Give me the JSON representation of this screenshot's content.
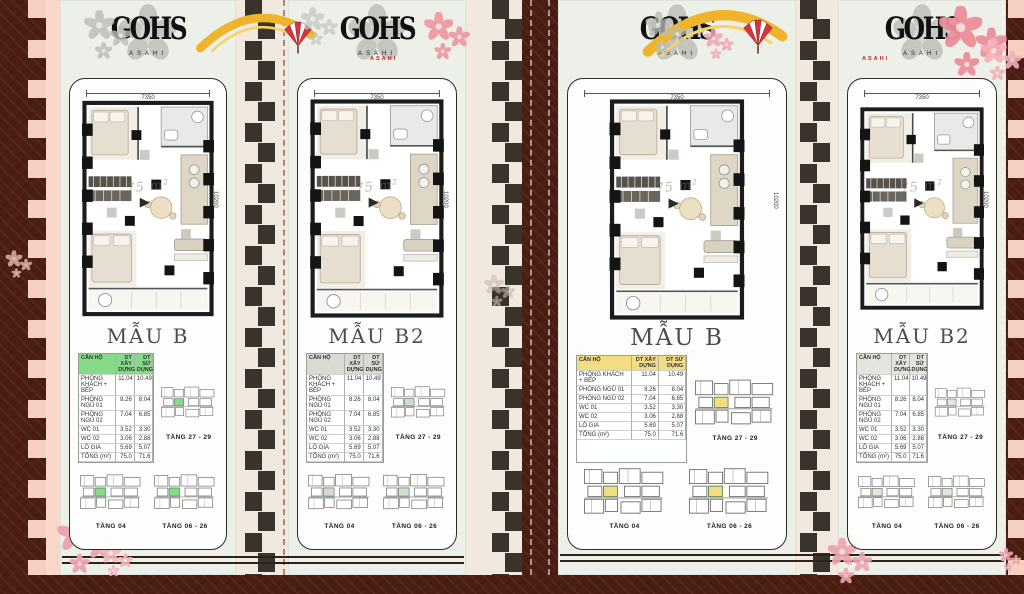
{
  "brand": {
    "logo_text": "GOHS",
    "logo_subtext": "ASAHI",
    "fan_label": "ASAHI"
  },
  "cards": [
    {
      "title": "MẪU B",
      "dim_top": "7350",
      "dim_side": "10200",
      "watermark": "75 m²",
      "upper_floor_label": "TẦNG 27 - 29",
      "bottom_floor_labels": [
        "TẦNG 04",
        "TẦNG 06 - 26"
      ],
      "accent": "#86db8b"
    },
    {
      "title": "MẪU B2",
      "dim_top": "7350",
      "dim_side": "10200",
      "watermark": "75 m²",
      "upper_floor_label": "TẦNG 27 - 29",
      "bottom_floor_labels": [
        "TẦNG 04",
        "TẦNG 06 - 26"
      ],
      "accent": "#d7dbd2"
    },
    {
      "title": "MẪU B",
      "dim_top": "7350",
      "dim_side": "10200",
      "watermark": "75 m²",
      "upper_floor_label": "TẦNG 27 - 29",
      "bottom_floor_labels": [
        "TẦNG 04",
        "TẦNG 06 - 26"
      ],
      "accent": "#f3dc82"
    },
    {
      "title": "MẪU B2",
      "dim_top": "7350",
      "dim_side": "10200",
      "watermark": "75 m²",
      "upper_floor_label": "TẦNG 27 - 29",
      "bottom_floor_labels": [
        "TẦNG 04",
        "TẦNG 06 - 26"
      ],
      "accent": "#e3e6df"
    }
  ],
  "table": {
    "header": [
      "CĂN HỘ",
      "DT XÂY DỰNG",
      "DT SỬ DỤNG"
    ],
    "rows": [
      [
        "PHÒNG KHÁCH + BẾP",
        "11.04",
        "10.49"
      ],
      [
        "PHÒNG NGỦ 01",
        "8.26",
        "8.04"
      ],
      [
        "PHÒNG NGỦ 02",
        "7.04",
        "6.85"
      ],
      [
        "WC 01",
        "3.52",
        "3.30"
      ],
      [
        "WC 02",
        "3.06",
        "2.88"
      ],
      [
        "LÔ GIA",
        "5.69",
        "5.07"
      ],
      [
        "TỔNG (m²)",
        "75.0",
        "71.6"
      ]
    ]
  },
  "colors": {
    "background": "#4c1d12",
    "panel": "#edefe9",
    "card": "#fdfdfb",
    "gold_arc": "#f0b42a",
    "pink_edge": "#f7d8ca",
    "zipper": "#3a332c",
    "accent_green": "#86db8b",
    "accent_yellow": "#f3dc82",
    "sakura_pink": "#ef9aa2"
  }
}
